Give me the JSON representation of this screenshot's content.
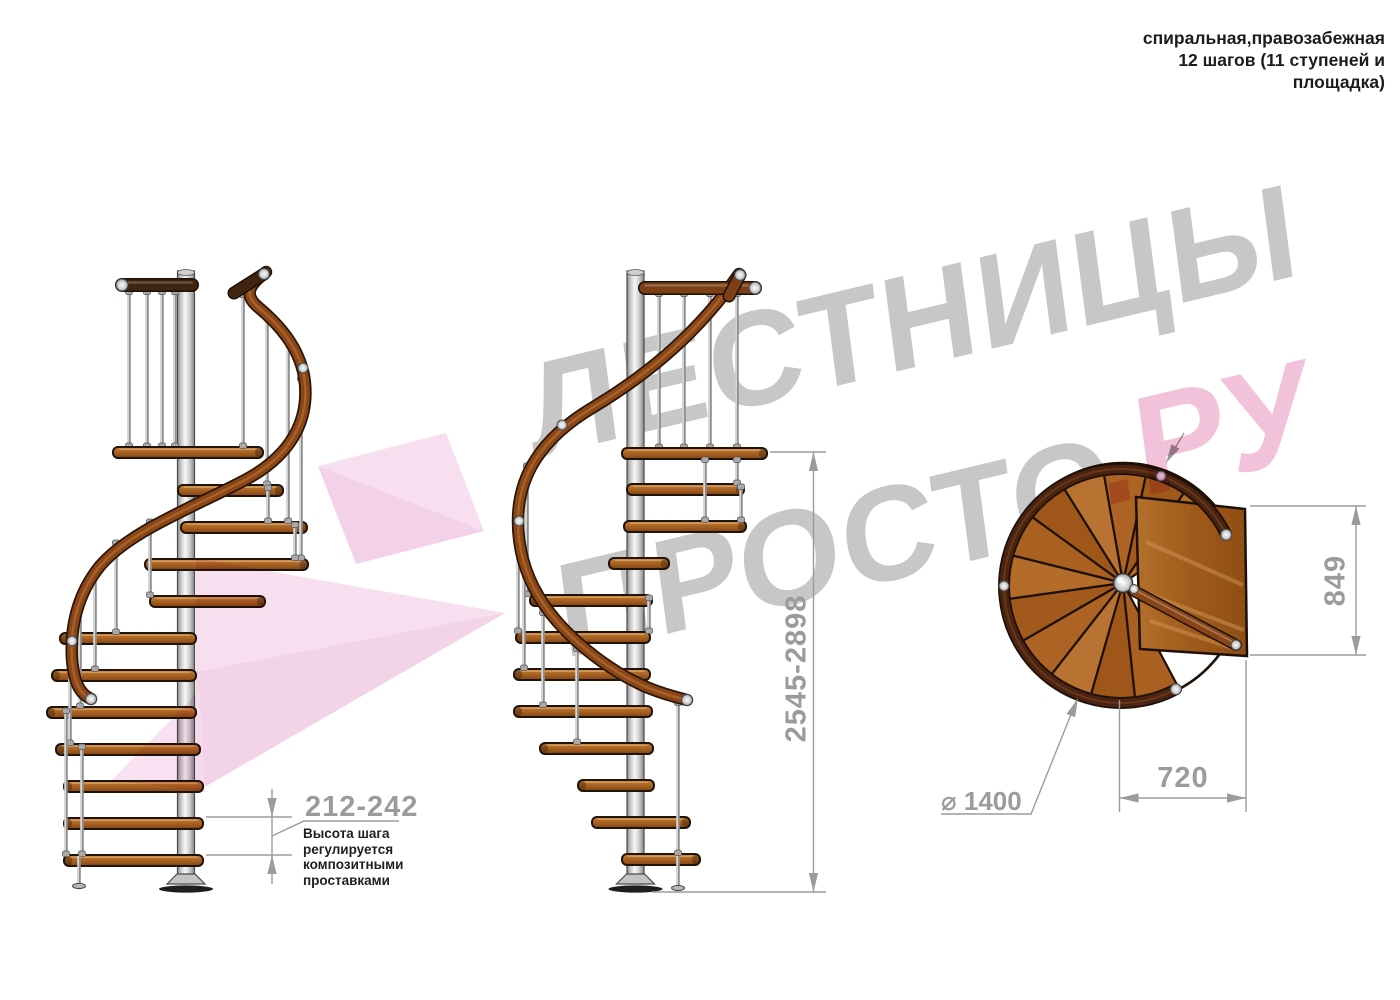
{
  "title": {
    "lines": [
      "спиральная,правозабежная",
      "12 шагов (11 ступеней и",
      "площадка)"
    ]
  },
  "watermark": {
    "word1": "ЛЕСТНИЦЫ",
    "word2": "ПРОСТО",
    "suffix": ".РУ"
  },
  "annotations": {
    "step_height": {
      "value": "212-242",
      "note_lines": [
        "Высота шага",
        "регулируется",
        "композитными",
        "проставками"
      ]
    },
    "total_height": {
      "value": "2545-2898"
    },
    "platform_depth": {
      "value": "849"
    },
    "platform_width": {
      "value": "720"
    },
    "diameter": {
      "value": "⌀ 1400"
    }
  },
  "colors": {
    "dimension": "#9b9b9b",
    "text": "#1c1c1c",
    "watermark_gray": "#c7c7c7",
    "watermark_pink": "#f2bed8",
    "logo_pink": "#f6d9ec",
    "logo_pink_dark": "#f0c7e1",
    "wood": "#a55e1e",
    "wood_dark": "#4a2410",
    "rail": "#8a4617",
    "rail_dark_balcony": "#3f2412",
    "rail_balcony": "#7c3f16",
    "metal": "#d9d9d9",
    "outline": "#20130a"
  }
}
